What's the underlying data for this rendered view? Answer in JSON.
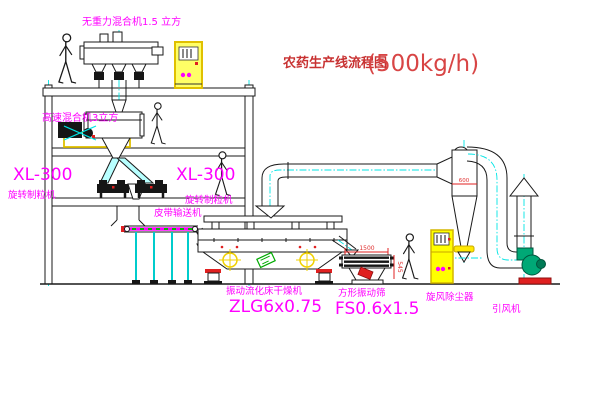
{
  "title": {
    "zh": "农药生产线流程图",
    "capacity": "(500kg/h)"
  },
  "labels": {
    "gravity_mixer": "无重力混合机1.5 立方",
    "high_speed_mixer": "高速混合机3立方",
    "xl300_left": "XL-300",
    "granulator_left": "旋转制粒机",
    "xl300_mid": "XL-300",
    "granulator_mid": "旋转制粒机",
    "belt_conveyor": "皮带输送机",
    "dryer_name": "振动流化床干燥机",
    "dryer_model": "ZLG6x0.75",
    "sieve_name": "方形振动筛",
    "sieve_model": "FS0.6x1.5",
    "cyclone": "旋风除尘器",
    "fan": "引风机"
  },
  "dimensions": {
    "sieve_width": "1500",
    "sieve_height": "545",
    "cyclone_diameter": "600"
  },
  "colors": {
    "label_magenta": "#ff00ff",
    "title_red": "#c83232",
    "centerline_cyan": "#00e5e5",
    "cabinet_yellow": "#ffff00",
    "conveyor_green": "#00bb00",
    "fan_teal": "#00a876",
    "line_black": "#1a1a1a"
  }
}
